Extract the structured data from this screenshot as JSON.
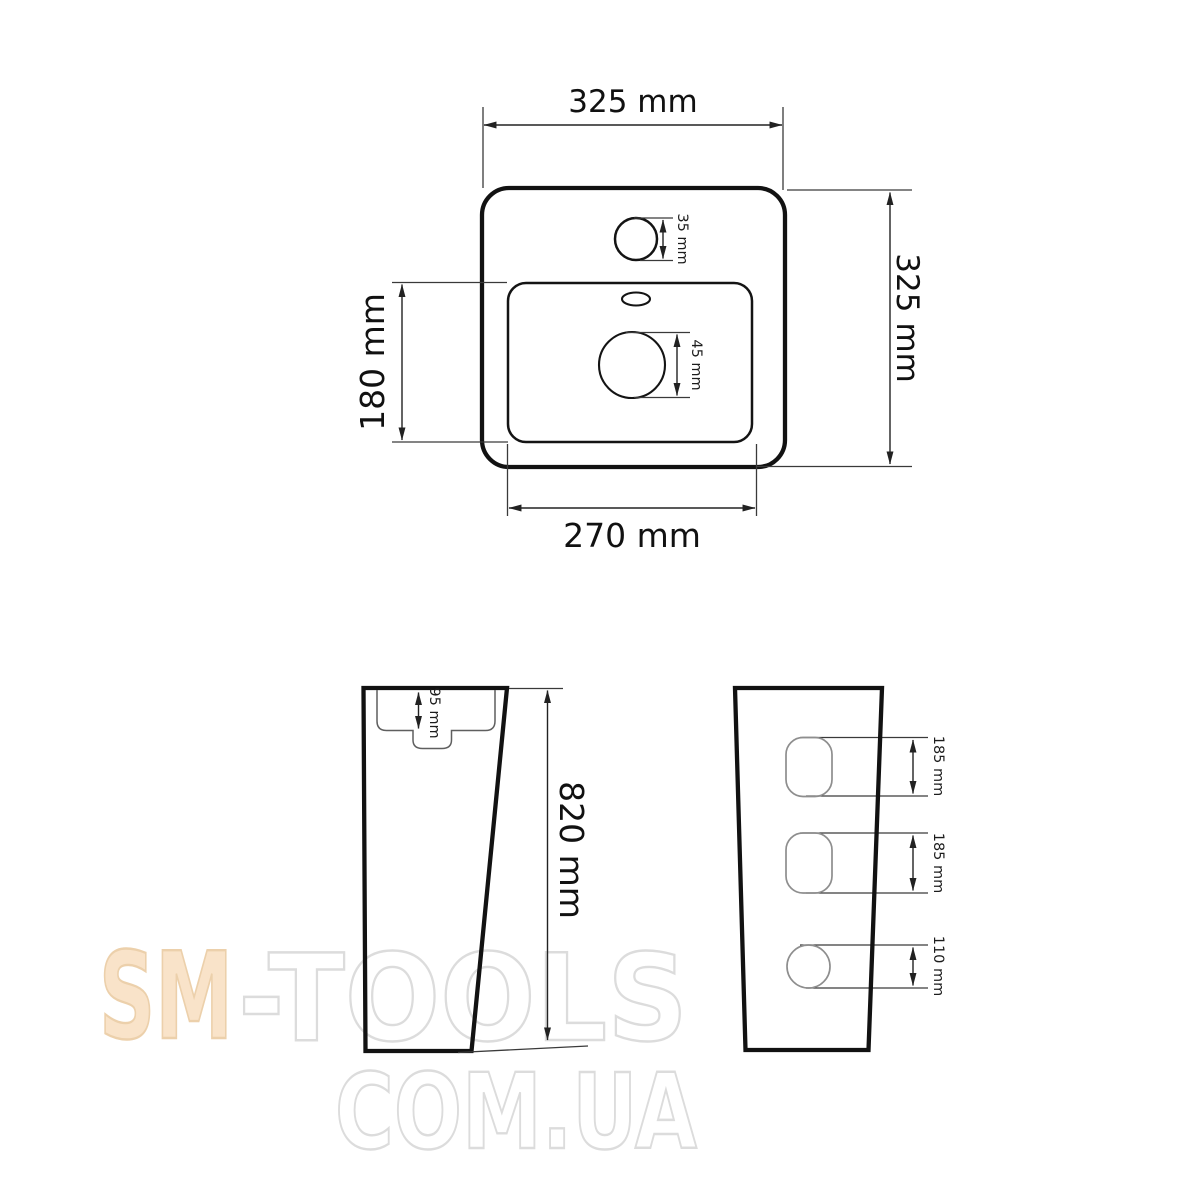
{
  "watermark": {
    "brand_prefix": "SM",
    "brand_suffix": "-TOOLS",
    "domain": "COM.UA",
    "prefix_fill": "#f9e3c9",
    "prefix_stroke": "#ecd0ab",
    "outline_stroke": "#dcdcdc"
  },
  "top_view": {
    "overall_width_label": "325 mm",
    "overall_depth_label": "325 mm",
    "basin_depth_label": "180 mm",
    "basin_width_label": "270 mm",
    "faucet_hole_label": "35 mm",
    "drain_hole_label": "45 mm"
  },
  "pedestal_side_view": {
    "recess_label": "95 mm",
    "height_label": "820 mm"
  },
  "pedestal_back_view": {
    "top_hole_label": "185 mm",
    "middle_hole_label": "185 mm",
    "bottom_hole_label": "110 mm"
  },
  "line_colors": {
    "drawing_outline": "#121212",
    "dimension_lines": "#222222",
    "hole_outline": "#8e8e8e"
  }
}
